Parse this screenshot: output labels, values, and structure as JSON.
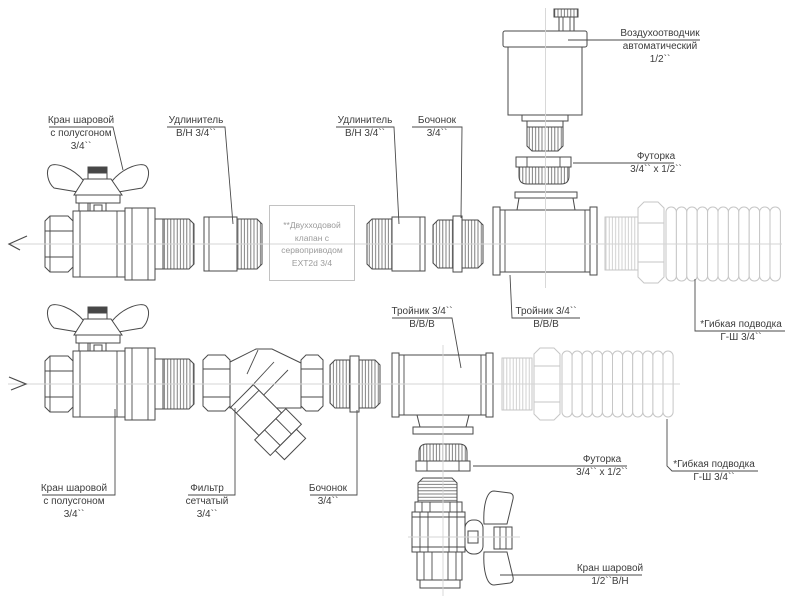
{
  "labels": {
    "ball_valve_top_left": {
      "lines": [
        "Кран шаровой",
        "с полусгоном",
        "3/4``"
      ]
    },
    "extender_1": {
      "lines": [
        "Удлинитель",
        "В/Н 3/4``"
      ]
    },
    "extender_2": {
      "lines": [
        "Удлинитель",
        "В/Н 3/4``"
      ]
    },
    "barrel_top": {
      "lines": [
        "Бочонок",
        "3/4``"
      ]
    },
    "air_vent": {
      "lines": [
        "Воздухоотводчик",
        "автоматический",
        "1/2``"
      ]
    },
    "bush_top": {
      "lines": [
        "Футорка",
        "3/4`` х 1/2``"
      ]
    },
    "tee_top": {
      "lines": [
        "Тройник 3/4``",
        "В/В/В"
      ]
    },
    "hose_top": {
      "lines": [
        "*Гибкая подводка",
        "Г-Ш 3/4``"
      ]
    },
    "tee_bottom": {
      "lines": [
        "Тройник 3/4``",
        "В/В/В"
      ]
    },
    "ball_valve_bottom_left": {
      "lines": [
        "Кран шаровой",
        "с полусгоном",
        "3/4``"
      ]
    },
    "filter": {
      "lines": [
        "Фильтр",
        "сетчатый",
        "3/4``"
      ]
    },
    "barrel_bottom": {
      "lines": [
        "Бочонок",
        "3/4``"
      ]
    },
    "bush_bottom": {
      "lines": [
        "Футорка",
        "3/4`` х 1/2``"
      ]
    },
    "hose_bottom": {
      "lines": [
        "*Гибкая подводка",
        "Г-Ш 3/4``"
      ]
    },
    "ball_valve_bottom_right": {
      "lines": [
        "Кран шаровой",
        "1/2``В/Н"
      ]
    }
  },
  "annotation_box": {
    "lines": [
      "**Двухходовой",
      "клапан с",
      "сервоприводом",
      "EXT2d 3/4"
    ]
  },
  "colors": {
    "line": "#4a4a4a",
    "hatch": "#606060",
    "light_part": "#c6c6c6",
    "centerline": "#d4d4d4",
    "label_text": "#3c3c3c",
    "box_text": "#9b9b9b",
    "box_border": "#c2c2c2",
    "handle_cap_fill": "#474747",
    "background": "#ffffff"
  }
}
